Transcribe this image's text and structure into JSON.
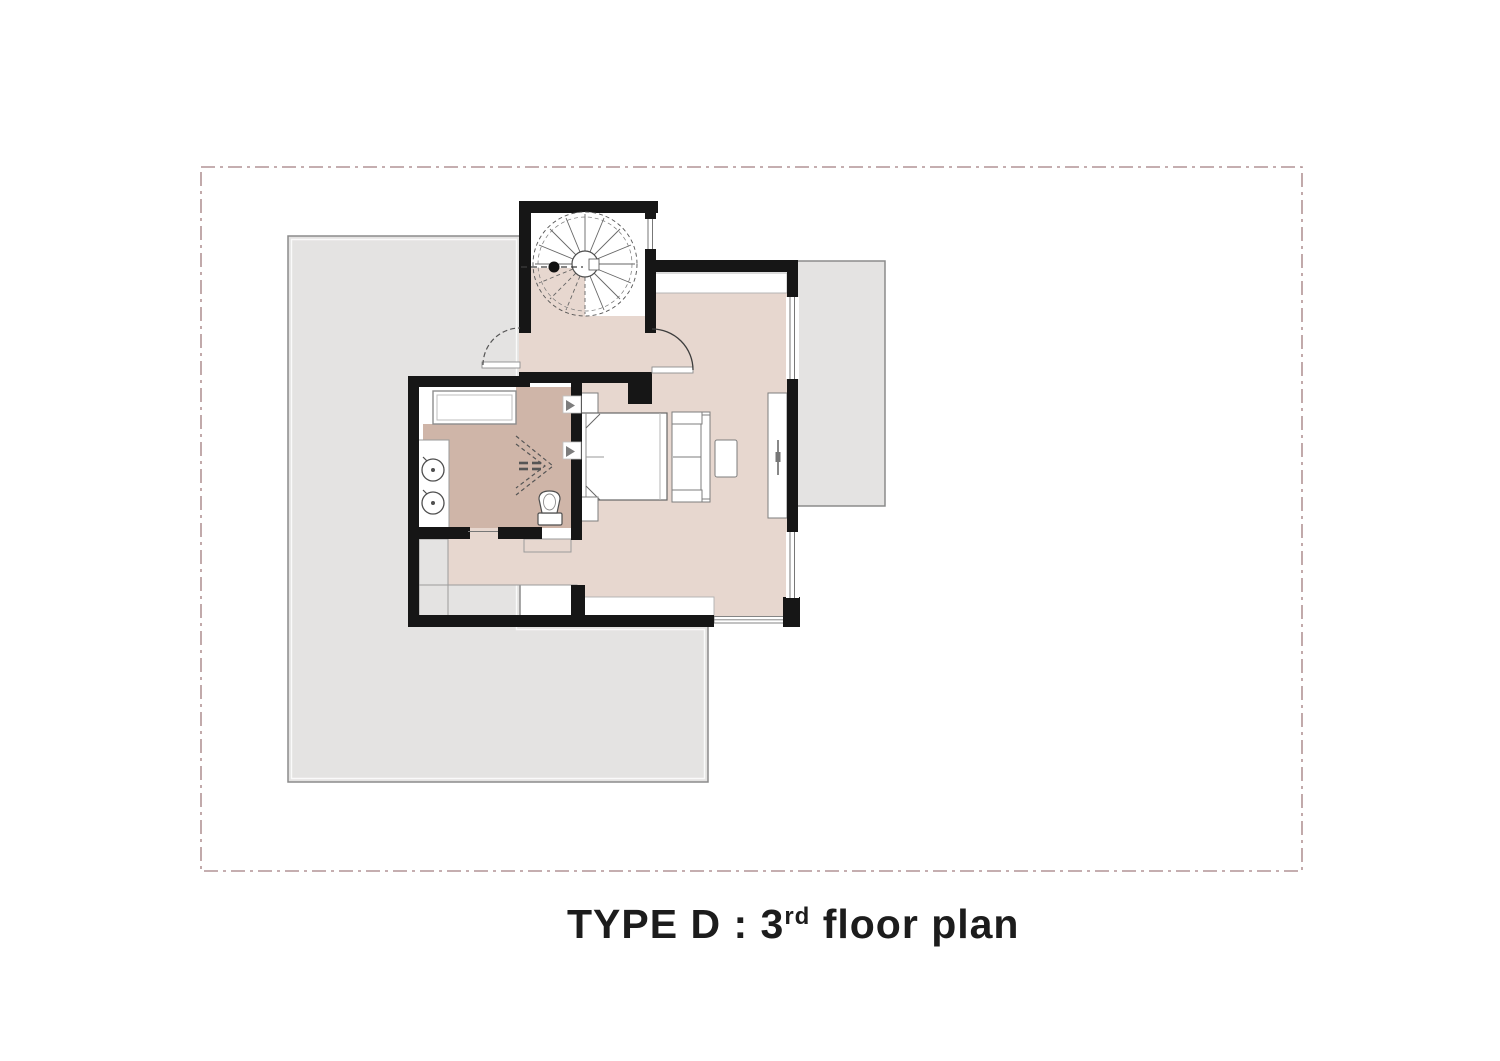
{
  "title": {
    "part1": "TYPE D : 3",
    "sup": "rd",
    "part2": " floor plan"
  },
  "colors": {
    "page-bg": "#ffffff",
    "boundary-dash": "#b29496",
    "terrace-fill": "#e4e3e2",
    "terrace-stroke": "#8b8b8b",
    "wall": "#161616",
    "floor-light": "#e7d7cf",
    "floor-dark": "#cfb5a8",
    "fixture-stroke": "#555555",
    "thin-line": "#9b9b9b",
    "title-color": "#1c1c1c"
  }
}
